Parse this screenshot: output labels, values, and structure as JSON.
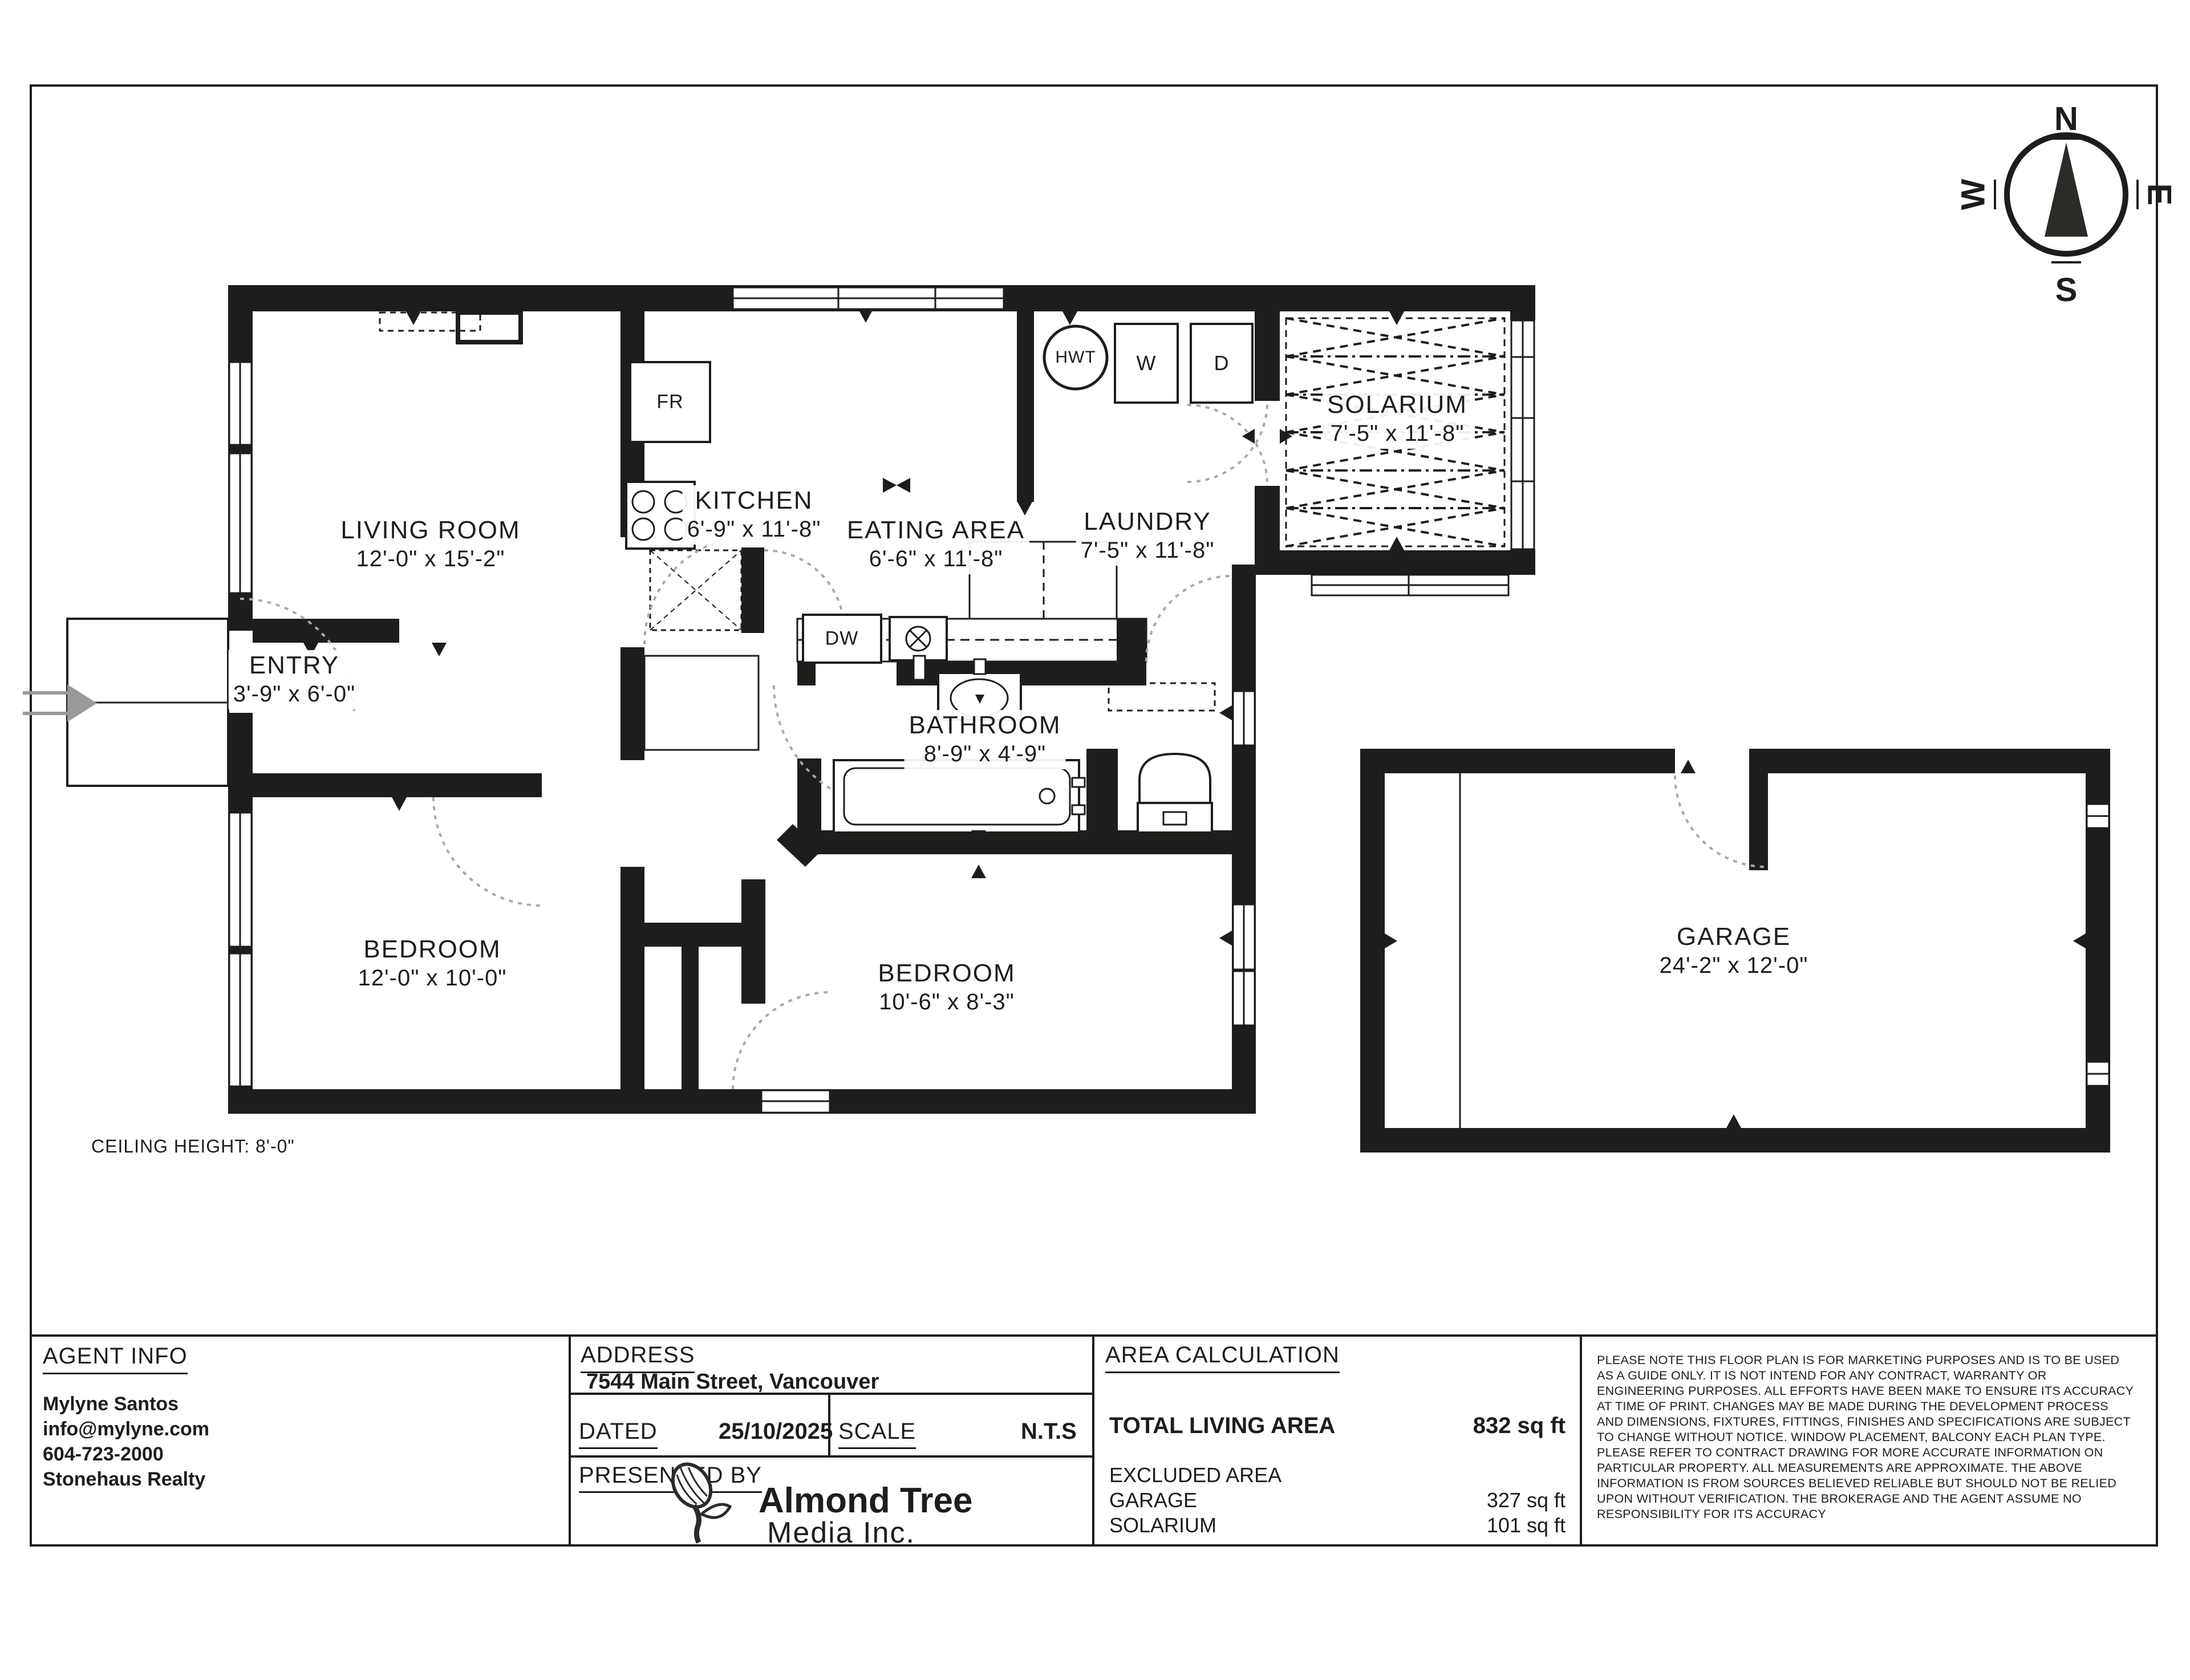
{
  "compass": {
    "n": "N",
    "e": "E",
    "s": "S",
    "w": "W"
  },
  "plan": {
    "ceiling_note": "CEILING HEIGHT: 8'-0\"",
    "rooms": [
      {
        "name": "LIVING ROOM",
        "dims": "12'-0\" x 15'-2\""
      },
      {
        "name": "ENTRY",
        "dims": "3'-9\" x 6'-0\""
      },
      {
        "name": "KITCHEN",
        "dims": "6'-9\" x 11'-8\""
      },
      {
        "name": "EATING AREA",
        "dims": "6'-6\" x 11'-8\""
      },
      {
        "name": "LAUNDRY",
        "dims": "7'-5\" x 11'-8\""
      },
      {
        "name": "SOLARIUM",
        "dims": "7'-5\" x 11'-8\""
      },
      {
        "name": "BATHROOM",
        "dims": "8'-9\" x 4'-9\""
      },
      {
        "name": "BEDROOM",
        "dims": "12'-0\" x 10'-0\""
      },
      {
        "name": "BEDROOM",
        "dims": "10'-6\" x 8'-3\""
      },
      {
        "name": "GARAGE",
        "dims": "24'-2\" x 12'-0\""
      }
    ],
    "appliances": {
      "fridge": "FR",
      "hot_water_tank": "HWT",
      "washer": "W",
      "dryer": "D",
      "dishwasher": "DW"
    }
  },
  "title_block": {
    "agent_info": {
      "heading": "AGENT INFO",
      "name": "Mylyne Santos",
      "email": "info@mylyne.com",
      "phone": "604-723-2000",
      "company": "Stonehaus Realty"
    },
    "address": {
      "heading": "ADDRESS",
      "value": "7544 Main Street, Vancouver"
    },
    "dated": {
      "label": "DATED",
      "value": "25/10/2025"
    },
    "scale": {
      "label": "SCALE",
      "value": "N.T.S"
    },
    "presented_by": {
      "label": "PRESENTED BY"
    },
    "logo": {
      "line1": "Almond Tree",
      "line2": "Media Inc."
    },
    "area_calculation": {
      "heading": "AREA CALCULATION",
      "total_label": "TOTAL LIVING AREA",
      "total_value": "832 sq ft",
      "excluded_label": "EXCLUDED AREA",
      "rows": [
        {
          "label": "GARAGE",
          "value": "327 sq ft"
        },
        {
          "label": "SOLARIUM",
          "value": "101 sq ft"
        }
      ]
    },
    "disclaimer": "PLEASE NOTE THIS FLOOR PLAN IS FOR MARKETING PURPOSES AND IS TO BE USED AS A GUIDE ONLY. IT IS NOT INTEND FOR ANY CONTRACT, WARRANTY OR ENGINEERING PURPOSES. ALL EFFORTS HAVE BEEN MAKE TO ENSURE ITS ACCURACY AT TIME OF PRINT. CHANGES MAY BE MADE DURING THE DEVELOPMENT PROCESS AND DIMENSIONS, FIXTURES, FITTINGS, FINISHES AND SPECIFICATIONS ARE SUBJECT TO CHANGE WITHOUT NOTICE. WINDOW PLACEMENT, BALCONY EACH PLAN TYPE. PLEASE REFER TO CONTRACT DRAWING FOR MORE ACCURATE INFORMATION ON PARTICULAR PROPERTY. ALL MEASUREMENTS ARE APPROXIMATE. THE ABOVE INFORMATION IS FROM SOURCES BELIEVED RELIABLE BUT SHOULD NOT BE RELIED UPON WITHOUT VERIFICATION. THE BROKERAGE AND THE AGENT ASSUME NO RESPONSIBILITY FOR ITS ACCURACY"
  }
}
